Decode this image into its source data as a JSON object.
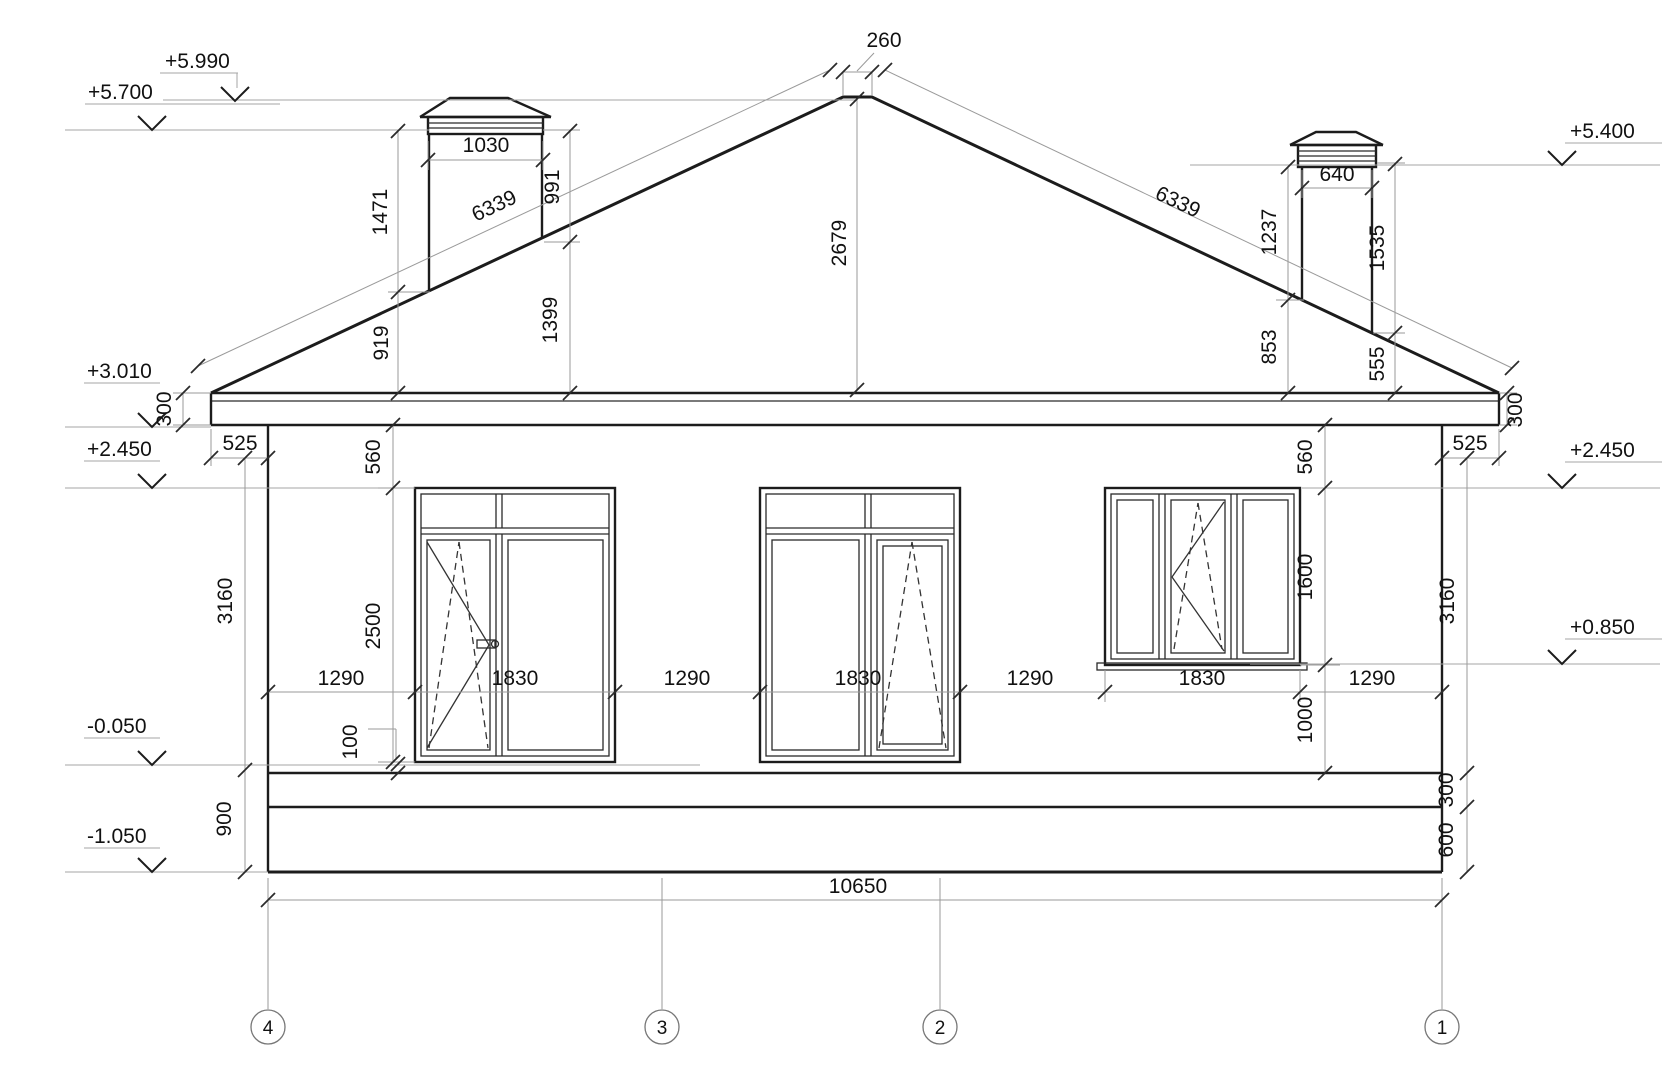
{
  "drawing": {
    "title": "House facade elevation",
    "levels": {
      "l5990": "+5.990",
      "l5700": "+5.700",
      "l3010": "+3.010",
      "l2450_left": "+2.450",
      "lm0050": "-0.050",
      "lm1050": "-1.050",
      "l5400": "+5.400",
      "l2450_right": "+2.450",
      "l0850": "+0.850"
    },
    "dims": {
      "ridge_width": "260",
      "slope_left": "6339",
      "slope_right": "6339",
      "roof_height": "2679",
      "chimney_left_width": "1030",
      "chimney_left_h1": "1471",
      "chimney_left_h2": "991",
      "chimney_left_h3": "1399",
      "chimney_left_h4": "919",
      "chimney_right_width": "640",
      "chimney_right_h1": "1237",
      "chimney_right_h2": "1535",
      "chimney_right_h3": "853",
      "chimney_right_h4": "555",
      "fascia_left": "300",
      "fascia_right": "300",
      "overhang_left": "525",
      "overhang_right": "525",
      "wintop_left": "560",
      "wintop_right": "560",
      "win12_height": "2500",
      "win3_height": "1600",
      "under_win3": "1000",
      "wall_left": "3160",
      "wall_right": "3160",
      "sill_gap": "100",
      "base_left": "900",
      "plinth_upper": "300",
      "plinth_lower": "600",
      "w1": "1290",
      "w2": "1830",
      "w3": "1290",
      "w4": "1830",
      "w5": "1290",
      "w6": "1830",
      "w7": "1290",
      "total_width": "10650"
    },
    "axes": {
      "a4": "4",
      "a3": "3",
      "a2": "2",
      "a1": "1"
    }
  }
}
